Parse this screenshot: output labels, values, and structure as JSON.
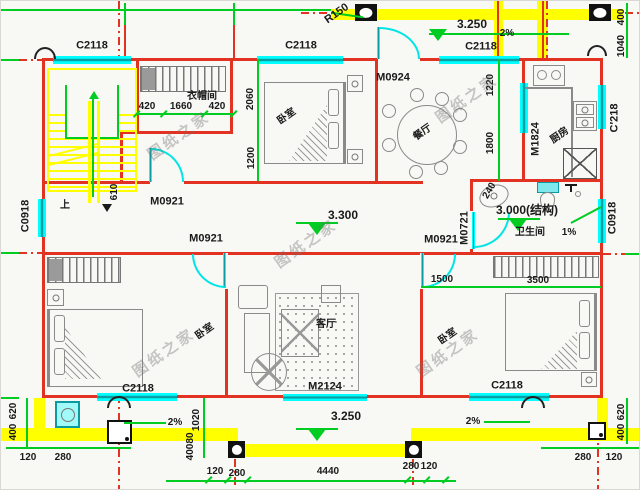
{
  "watermark": {
    "text": "图纸之家"
  },
  "rooms": {
    "cloakroom": "衣帽间",
    "bedroom": "卧室",
    "dining": "餐厅",
    "kitchen": "厨房",
    "bathroom": "卫生间",
    "living": "客厅",
    "stairs_up": "上"
  },
  "openings": {
    "c2118": "C2118",
    "c0918": "C0918",
    "c218": "C′218",
    "m0921": "M0921",
    "m0924": "M0924",
    "m1824": "M1824",
    "m0721": "M0721",
    "m2124": "M2124"
  },
  "annotations": {
    "r150": "R150",
    "level_3250": "3.250",
    "level_3300": "3.300",
    "level_3000": "3.000(结构)",
    "slope_2": "2%",
    "slope_1": "1%"
  },
  "dimensions": {
    "d80": "80",
    "d120": "120",
    "d240": "240",
    "d280": "280",
    "d400": "400",
    "d420": "420",
    "d610": "610",
    "d620": "620",
    "d1020": "1020",
    "d1040": "1040",
    "d1200": "1200",
    "d1220": "1220",
    "d1500": "1500",
    "d1660": "1660",
    "d1800": "1800",
    "d2060": "2060",
    "d3500": "3500",
    "d4440": "4440"
  },
  "colors": {
    "wall": "#e23322",
    "dimension": "#00cc22",
    "slab": "#ffff00",
    "opening_glass": "#00ffff"
  }
}
